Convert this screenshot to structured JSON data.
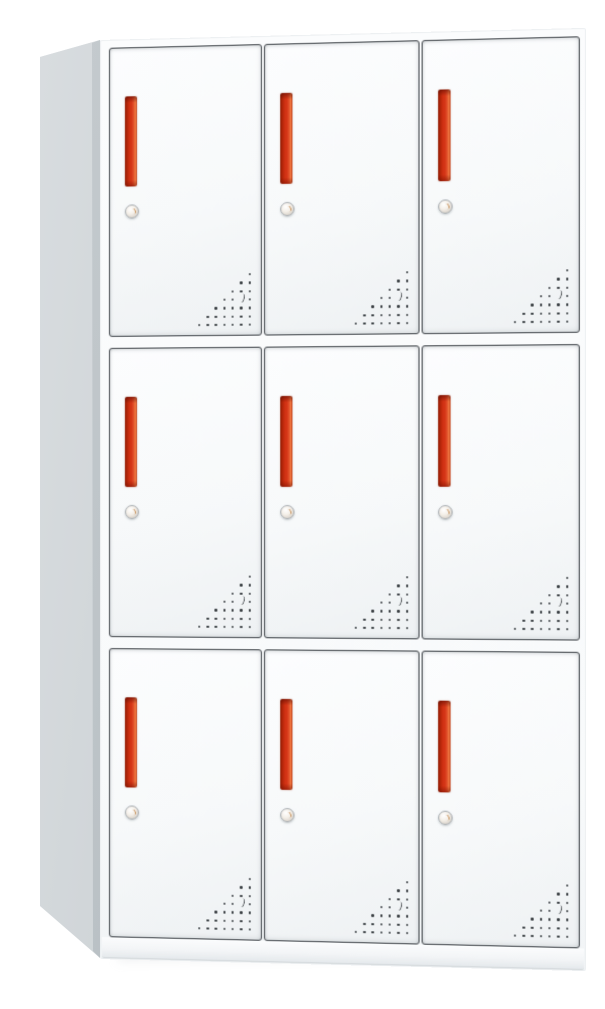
{
  "scene": {
    "description": "Product photo of a white steel nine-door locker cabinet, viewed from slightly left, on a plain white background",
    "background_color": "#ffffff"
  },
  "cabinet": {
    "type": "nine-door-locker",
    "rows": 3,
    "columns": 3,
    "door_count": 9,
    "colors": {
      "body": "#f9fafb",
      "side_panel": "#ccd1d4",
      "door_fill": "#f7f9fa",
      "door_border": "#41464b",
      "handle_main": "#d53617",
      "handle_dark": "#8f1d05",
      "handle_highlight": "#ef7a42",
      "lock_ring": "#a6abaf",
      "lock_face": "#f4efe8",
      "lock_mark": "#c08448",
      "vent_dot": "#3a3f43",
      "base_edge": "#d3d8db"
    },
    "door_features": {
      "handle": "vertical recessed red-orange grip slot",
      "lock": "small round cam lock below handle",
      "vents": {
        "rows": 7,
        "pattern": "right-aligned triangular grid of perforation holes in bottom-right corner, one hole replaced by a crescent cutout",
        "spacing_px": 8.3,
        "crescent_row_index": 3,
        "crescent_col_index_from_right": 1
      }
    },
    "doors": [
      {
        "id": "door-r1c1",
        "row": 1,
        "col": 1
      },
      {
        "id": "door-r1c2",
        "row": 1,
        "col": 2
      },
      {
        "id": "door-r1c3",
        "row": 1,
        "col": 3
      },
      {
        "id": "door-r2c1",
        "row": 2,
        "col": 1
      },
      {
        "id": "door-r2c2",
        "row": 2,
        "col": 2
      },
      {
        "id": "door-r2c3",
        "row": 2,
        "col": 3
      },
      {
        "id": "door-r3c1",
        "row": 3,
        "col": 1
      },
      {
        "id": "door-r3c2",
        "row": 3,
        "col": 2
      },
      {
        "id": "door-r3c3",
        "row": 3,
        "col": 3
      }
    ]
  }
}
